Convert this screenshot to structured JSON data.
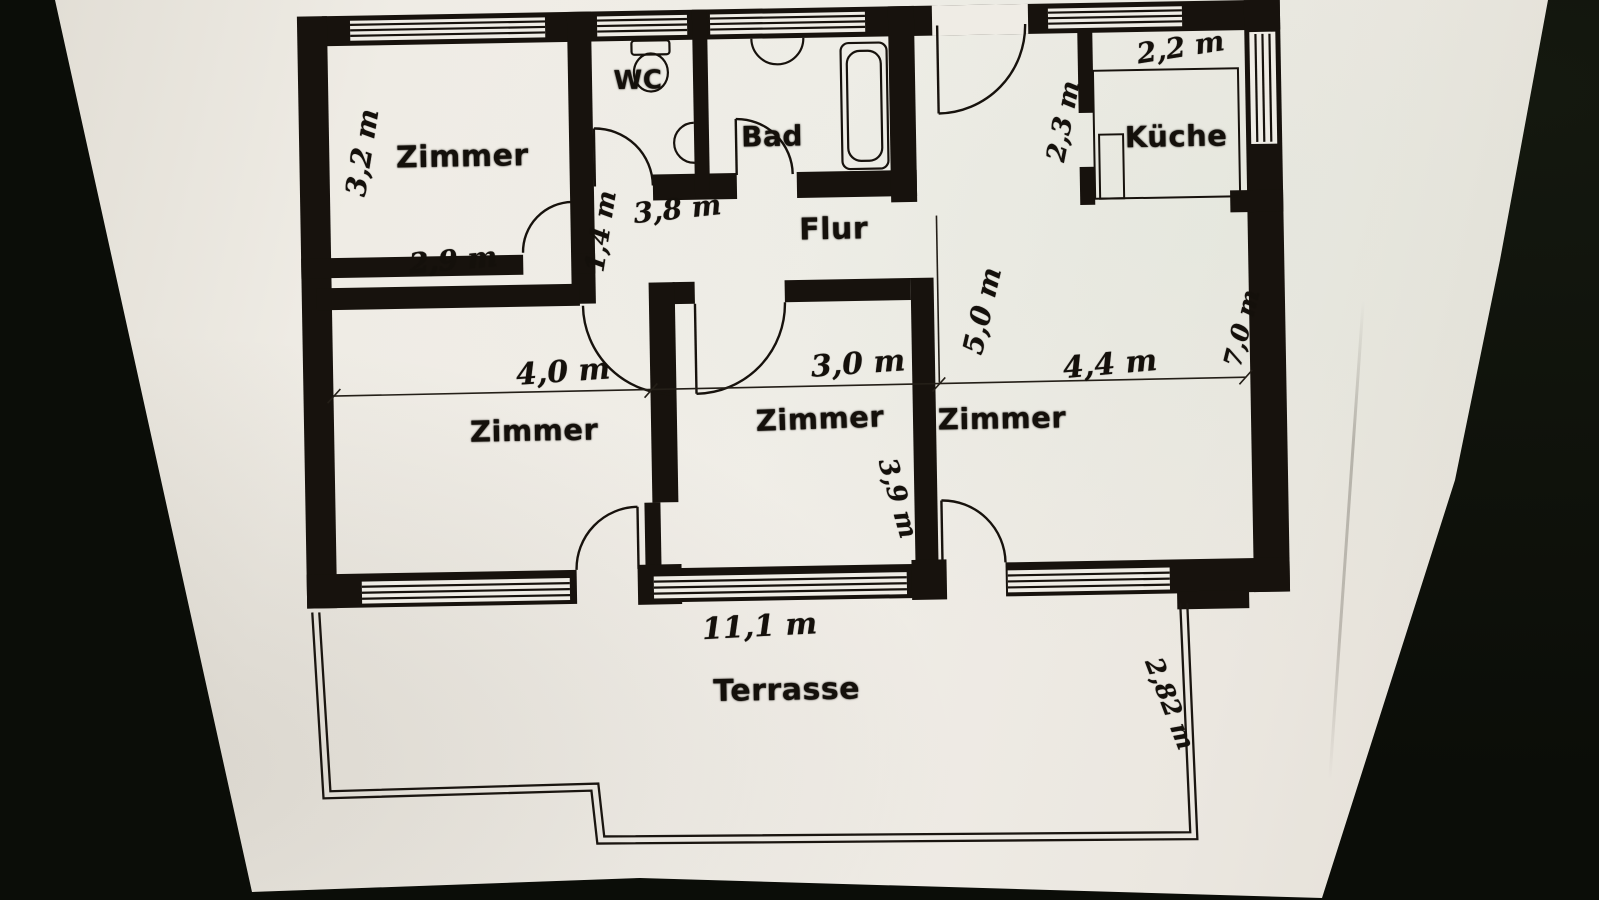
{
  "document": {
    "kind": "Wohnungsgrundriss (scanned floor plan)"
  },
  "rooms": {
    "zimmer_top_left": {
      "label": "Zimmer",
      "height": "3,2 m",
      "width": "2,9 m"
    },
    "wc": {
      "label": "WC"
    },
    "bad": {
      "label": "Bad"
    },
    "flur": {
      "label": "Flur",
      "width": "3,8 m",
      "height": "1,4 m"
    },
    "kueche": {
      "label": "Küche",
      "width": "2,2 m",
      "height": "2,3 m"
    },
    "zimmer_left": {
      "label": "Zimmer",
      "width": "4,0 m"
    },
    "zimmer_middle": {
      "label": "Zimmer",
      "width": "3,0 m",
      "height": "3,9 m"
    },
    "zimmer_right": {
      "label": "Zimmer",
      "width": "4,4 m",
      "height": "5,0 m"
    },
    "terrasse": {
      "label": "Terrasse",
      "width": "11,1 m",
      "depth": "2,82 m"
    }
  },
  "dimensions": {
    "right_side_total": "7,0 m"
  },
  "colors": {
    "background": "#0b0d08",
    "paper": "#efece5",
    "ink": "#17120d"
  }
}
